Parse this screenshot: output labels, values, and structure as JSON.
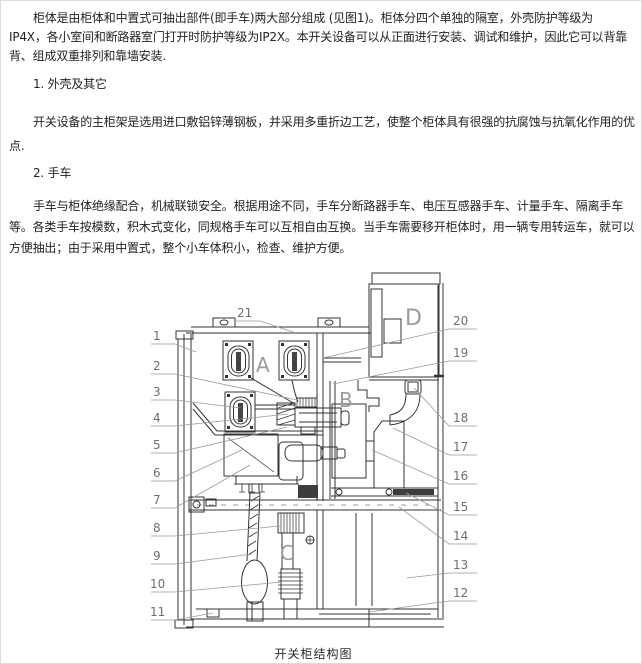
{
  "document": {
    "lines": [
      "柜体是由柜体和中置式可抽出部件(即手车)两大部分组成  (见图1)。柜体分四个单独的隔室，外壳防护等级为",
      "IP4X，各小室间和断路器室门打开时防护等级为IP2X。本开关设备可以从正面进行安装、调试和维护，因此它可以背靠",
      "背、组成双重排列和靠墙安装.",
      "1. 外壳及其它",
      "开关设备的主柜架是选用进口敷铝锌薄钢板，并采用多重折边工艺，使整个柜体具有很强的抗腐蚀与抗氧化作用的优",
      "点.",
      "2. 手车",
      "手车与柜体绝缘配合，机械联锁安全。根据用途不同，手车分断路器手车、电压互感器手车、计量手车、隔离手车",
      "等。各类手车按模数，积木式变化，同规格手车可以互相自由互换。当手车需要移开柜体时，用一辆专用转运车，就可以",
      "方便抽出；由于采用中置式，整个小车体积小，检查、维护方便。"
    ]
  },
  "diagram": {
    "caption": "开关柜结构图",
    "compartments": [
      "A",
      "B",
      "C",
      "D"
    ],
    "callouts": [
      "1",
      "2",
      "3",
      "4",
      "5",
      "6",
      "7",
      "8",
      "9",
      "10",
      "11",
      "12",
      "13",
      "14",
      "15",
      "16",
      "17",
      "18",
      "19",
      "20",
      "21"
    ]
  }
}
